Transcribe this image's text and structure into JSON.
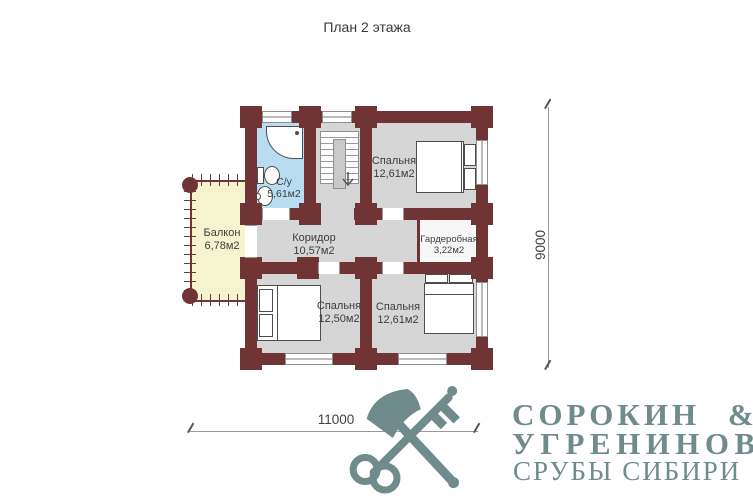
{
  "title": "План 2 этажа",
  "rooms": [
    {
      "name": "Спальня",
      "area": "12,61м2"
    },
    {
      "name": "С/у",
      "area": "5,61м2"
    },
    {
      "name": "Балкон",
      "area": "6,78м2"
    },
    {
      "name": "Коридор",
      "area": "10,57м2"
    },
    {
      "name": "Гардеробная",
      "area": "3,22м2"
    },
    {
      "name": "Спальня",
      "area": "12,50м2"
    },
    {
      "name": "Спальня",
      "area": "12,61м2"
    }
  ],
  "dimensions": {
    "horizontal": "11000",
    "vertical": "9000"
  },
  "logo": {
    "line1": "СОРОКИН &",
    "line2": "УГРЕНИНОВ",
    "line3": "СРУБЫ СИБИРИ"
  },
  "colors": {
    "wall": "#6f3433",
    "floor": "#d7d6d6",
    "bathroom": "#b8ddf2",
    "balcony": "#f6f4cf",
    "brand": "#6f8b8c"
  }
}
